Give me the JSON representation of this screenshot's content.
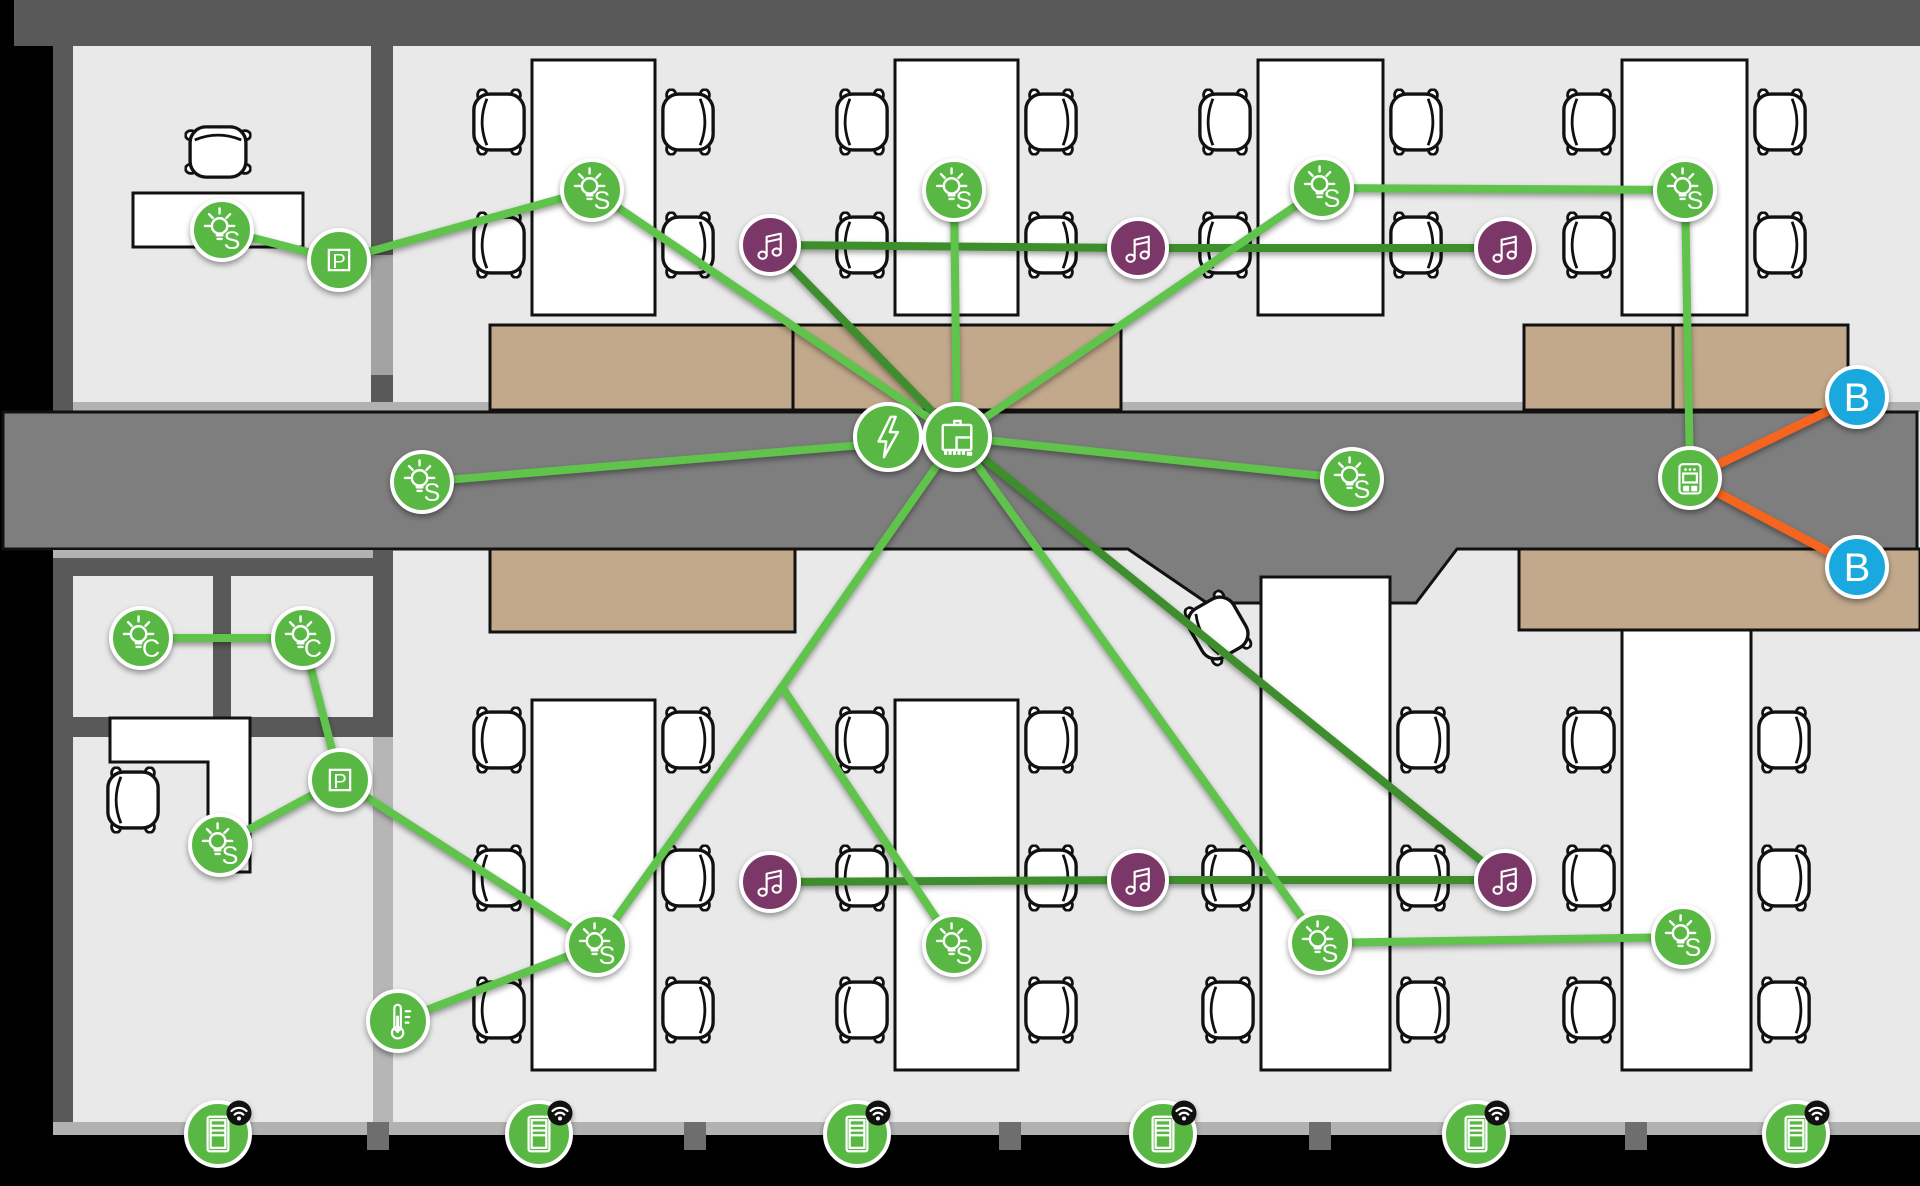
{
  "scene": {
    "width": 1920,
    "height": 1186,
    "background": "#000000"
  },
  "palette": {
    "node_green": "#58b843",
    "music_purple": "#7b3767",
    "beacon_blue": "#19a9de",
    "line_light_green": "#5fc34c",
    "line_dark_green": "#3e8e2d",
    "line_orange": "#f4651f",
    "floor": "#e9e9e9",
    "corridor": "#7e7e7e",
    "wall_dark": "#595959",
    "wall_light": "#b2b2b2",
    "door_light": "#a3a3a3",
    "glass_wall": "#b6b6b6",
    "counter_tan": "#c2a98c",
    "badge_black": "#111111",
    "icon_white": "#ffffff"
  },
  "nodes": [
    {
      "id": "s1",
      "icon": "bulb",
      "label": "S",
      "x": 222,
      "y": 230,
      "r": 30,
      "fill": "node_green"
    },
    {
      "id": "p1",
      "icon": "p-square",
      "label": "P",
      "x": 339,
      "y": 260,
      "r": 30,
      "fill": "node_green"
    },
    {
      "id": "s2",
      "icon": "bulb",
      "label": "S",
      "x": 592,
      "y": 190,
      "r": 30,
      "fill": "node_green"
    },
    {
      "id": "s3",
      "icon": "bulb",
      "label": "S",
      "x": 954,
      "y": 190,
      "r": 30,
      "fill": "node_green"
    },
    {
      "id": "s4",
      "icon": "bulb",
      "label": "S",
      "x": 1322,
      "y": 188,
      "r": 30,
      "fill": "node_green"
    },
    {
      "id": "s5",
      "icon": "bulb",
      "label": "S",
      "x": 1685,
      "y": 190,
      "r": 30,
      "fill": "node_green"
    },
    {
      "id": "m1",
      "icon": "music",
      "label": "",
      "x": 770,
      "y": 245,
      "r": 29,
      "fill": "music_purple"
    },
    {
      "id": "m2",
      "icon": "music",
      "label": "",
      "x": 1138,
      "y": 248,
      "r": 29,
      "fill": "music_purple"
    },
    {
      "id": "m3",
      "icon": "music",
      "label": "",
      "x": 1505,
      "y": 248,
      "r": 29,
      "fill": "music_purple"
    },
    {
      "id": "s6",
      "icon": "bulb",
      "label": "S",
      "x": 422,
      "y": 482,
      "r": 30,
      "fill": "node_green"
    },
    {
      "id": "s7",
      "icon": "bulb",
      "label": "S",
      "x": 1352,
      "y": 479,
      "r": 30,
      "fill": "node_green"
    },
    {
      "id": "gw",
      "icon": "switch",
      "label": "",
      "x": 1690,
      "y": 478,
      "r": 30,
      "fill": "node_green"
    },
    {
      "id": "b1",
      "icon": "letter",
      "label": "B",
      "x": 1857,
      "y": 397,
      "r": 30,
      "fill": "beacon_blue"
    },
    {
      "id": "b2",
      "icon": "letter",
      "label": "B",
      "x": 1857,
      "y": 567,
      "r": 30,
      "fill": "beacon_blue"
    },
    {
      "id": "c1",
      "icon": "bulb",
      "label": "C",
      "x": 141,
      "y": 638,
      "r": 30,
      "fill": "node_green"
    },
    {
      "id": "c2",
      "icon": "bulb",
      "label": "C",
      "x": 303,
      "y": 638,
      "r": 30,
      "fill": "node_green"
    },
    {
      "id": "p2",
      "icon": "p-square",
      "label": "P",
      "x": 340,
      "y": 780,
      "r": 30,
      "fill": "node_green"
    },
    {
      "id": "s8",
      "icon": "bulb",
      "label": "S",
      "x": 220,
      "y": 845,
      "r": 30,
      "fill": "node_green"
    },
    {
      "id": "t1",
      "icon": "thermometer",
      "label": "",
      "x": 398,
      "y": 1021,
      "r": 30,
      "fill": "node_green"
    },
    {
      "id": "s9",
      "icon": "bulb",
      "label": "S",
      "x": 597,
      "y": 945,
      "r": 30,
      "fill": "node_green"
    },
    {
      "id": "s10",
      "icon": "bulb",
      "label": "S",
      "x": 954,
      "y": 945,
      "r": 30,
      "fill": "node_green"
    },
    {
      "id": "m4",
      "icon": "music",
      "label": "",
      "x": 770,
      "y": 882,
      "r": 29,
      "fill": "music_purple"
    },
    {
      "id": "m5",
      "icon": "music",
      "label": "",
      "x": 1138,
      "y": 880,
      "r": 29,
      "fill": "music_purple"
    },
    {
      "id": "m6",
      "icon": "music",
      "label": "",
      "x": 1505,
      "y": 880,
      "r": 29,
      "fill": "music_purple"
    },
    {
      "id": "s11",
      "icon": "bulb",
      "label": "S",
      "x": 1320,
      "y": 943,
      "r": 30,
      "fill": "node_green"
    },
    {
      "id": "s12",
      "icon": "bulb",
      "label": "S",
      "x": 1683,
      "y": 937,
      "r": 30,
      "fill": "node_green"
    },
    {
      "id": "bolt",
      "icon": "lightning",
      "label": "",
      "x": 888,
      "y": 437,
      "r": 33,
      "fill": "node_green"
    },
    {
      "id": "hub",
      "icon": "controller",
      "label": "",
      "x": 957,
      "y": 437,
      "r": 33,
      "fill": "node_green"
    },
    {
      "id": "tab1",
      "icon": "tablet",
      "badge": "wifi",
      "label": "",
      "x": 218,
      "y": 1134,
      "r": 32,
      "fill": "node_green"
    },
    {
      "id": "tab2",
      "icon": "tablet",
      "badge": "wifi",
      "label": "",
      "x": 539,
      "y": 1134,
      "r": 32,
      "fill": "node_green"
    },
    {
      "id": "tab3",
      "icon": "tablet",
      "badge": "wifi",
      "label": "",
      "x": 857,
      "y": 1134,
      "r": 32,
      "fill": "node_green"
    },
    {
      "id": "tab4",
      "icon": "tablet",
      "badge": "wifi",
      "label": "",
      "x": 1163,
      "y": 1134,
      "r": 32,
      "fill": "node_green"
    },
    {
      "id": "tab5",
      "icon": "tablet",
      "badge": "wifi",
      "label": "",
      "x": 1476,
      "y": 1134,
      "r": 32,
      "fill": "node_green"
    },
    {
      "id": "tab6",
      "icon": "tablet",
      "badge": "wifi",
      "label": "",
      "x": 1796,
      "y": 1134,
      "r": 32,
      "fill": "node_green"
    }
  ],
  "junctions": [
    {
      "id": "j1",
      "x": 782,
      "y": 687
    }
  ],
  "edges": [
    {
      "a": "m1",
      "b": "hub",
      "color": "line_dark_green"
    },
    {
      "a": "m1",
      "b": "m2",
      "color": "line_dark_green"
    },
    {
      "a": "m2",
      "b": "m3",
      "color": "line_dark_green"
    },
    {
      "a": "m4",
      "b": "m5",
      "color": "line_dark_green"
    },
    {
      "a": "m5",
      "b": "m6",
      "color": "line_dark_green"
    },
    {
      "a": "hub",
      "b": "m6",
      "color": "line_dark_green"
    },
    {
      "a": "s1",
      "b": "p1",
      "color": "line_light_green"
    },
    {
      "a": "p1",
      "b": "s2",
      "color": "line_light_green"
    },
    {
      "a": "s2",
      "b": "hub",
      "color": "line_light_green"
    },
    {
      "a": "s3",
      "b": "hub",
      "color": "line_light_green"
    },
    {
      "a": "s4",
      "b": "hub",
      "color": "line_light_green"
    },
    {
      "a": "s4",
      "b": "s5",
      "color": "line_light_green"
    },
    {
      "a": "s5",
      "b": "gw",
      "color": "line_light_green"
    },
    {
      "a": "hub",
      "b": "s6",
      "color": "line_light_green"
    },
    {
      "a": "hub",
      "b": "s7",
      "color": "line_light_green"
    },
    {
      "a": "hub",
      "b": "j1",
      "color": "line_light_green"
    },
    {
      "a": "j1",
      "b": "s9",
      "color": "line_light_green"
    },
    {
      "a": "j1",
      "b": "s10",
      "color": "line_light_green"
    },
    {
      "a": "hub",
      "b": "s11",
      "color": "line_light_green"
    },
    {
      "a": "s11",
      "b": "s12",
      "color": "line_light_green"
    },
    {
      "a": "c1",
      "b": "c2",
      "color": "line_light_green"
    },
    {
      "a": "c2",
      "b": "p2",
      "color": "line_light_green"
    },
    {
      "a": "p2",
      "b": "s8",
      "color": "line_light_green"
    },
    {
      "a": "p2",
      "b": "s9",
      "color": "line_light_green"
    },
    {
      "a": "s9",
      "b": "t1",
      "color": "line_light_green"
    },
    {
      "a": "gw",
      "b": "b1",
      "color": "line_orange"
    },
    {
      "a": "gw",
      "b": "b2",
      "color": "line_orange"
    }
  ]
}
